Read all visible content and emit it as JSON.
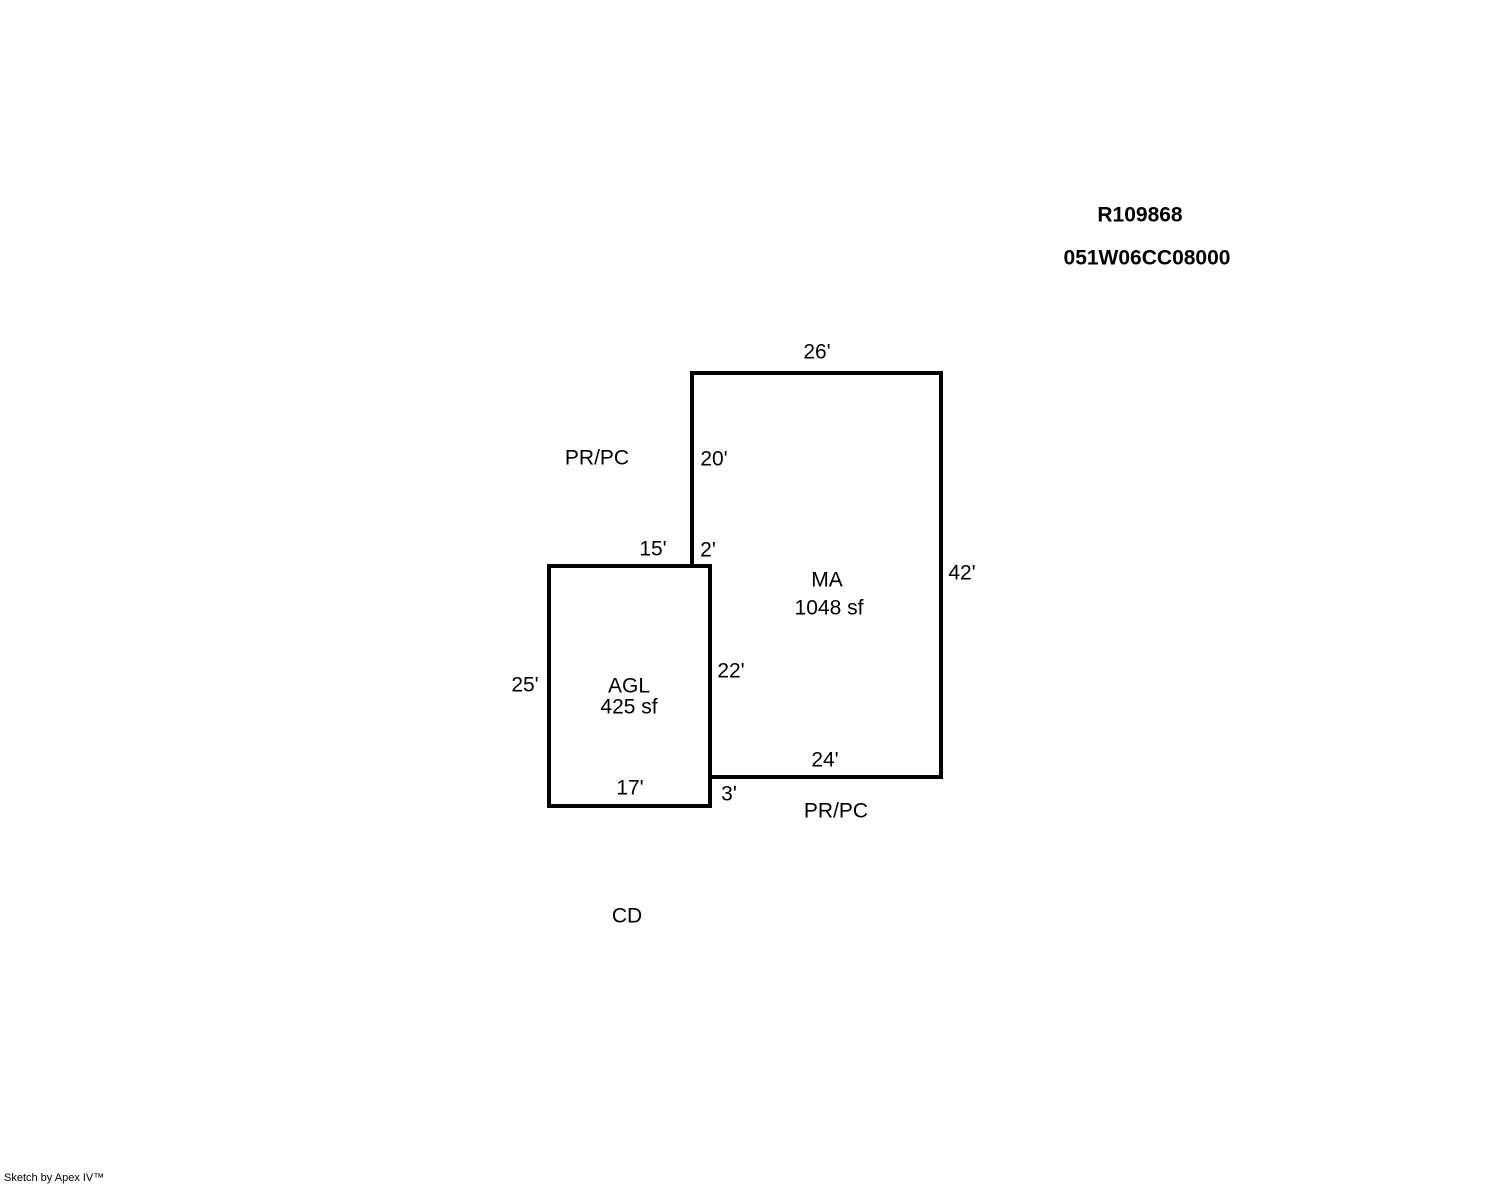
{
  "header": {
    "record_number": "R109868",
    "parcel_number": "051W06CC08000"
  },
  "sketch": {
    "ma": {
      "code": "MA",
      "area": "1048 sf",
      "dim_top": "26'",
      "dim_left": "20'",
      "dim_right": "42'",
      "dim_bottom": "24'",
      "dim_notch": "2'"
    },
    "agl": {
      "code": "AGL",
      "area": "425 sf",
      "dim_top": "15'",
      "dim_left": "25'",
      "dim_bottom": "17'",
      "dim_right_shared": "22'",
      "dim_right_lower": "3'"
    },
    "annotations": {
      "porch_upper": "PR/PC",
      "porch_lower": "PR/PC",
      "carport": "CD"
    }
  },
  "colors": {
    "line": "#000000",
    "background": "#ffffff"
  },
  "footer": {
    "credit": "Sketch by Apex IV™"
  }
}
